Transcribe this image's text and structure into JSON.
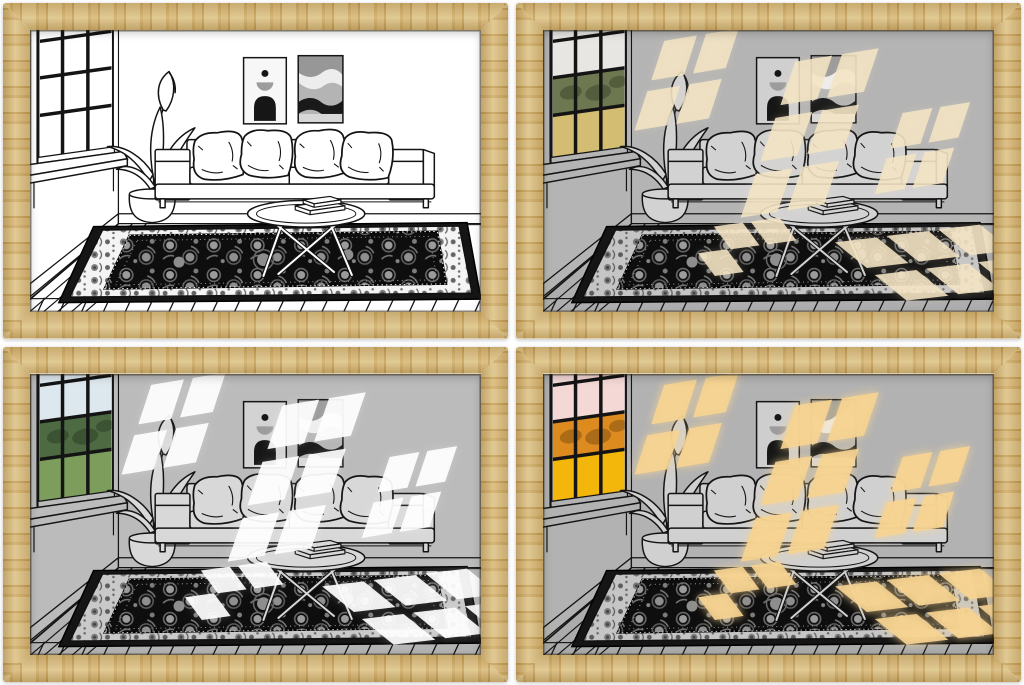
{
  "collage": {
    "rows": 2,
    "cols": 2,
    "panel_count": 4,
    "background": "#ffffff"
  },
  "frame": {
    "material_look": "light oak wood, mitered corners",
    "colors": {
      "a": "#d9bd80",
      "b": "#c9a55f",
      "c": "#d4b271",
      "d": "#bf9950"
    }
  },
  "scene_objects": [
    "paned window with landscape view",
    "potted houseplant",
    "three-seat sofa",
    "four throw pillows",
    "round coffee table",
    "stacked books",
    "two abstract wall art prints",
    "oriental area rug",
    "plank wood floor",
    "baseboard"
  ],
  "panels": [
    {
      "id": "top-left",
      "description": "Line-art living room, light off: pure black outlines on white",
      "light_opacity": "0",
      "glow_opacity": "0",
      "window_detail_opacity": "0",
      "colors": {
        "wall": "#ffffff",
        "floor": "#ffffff",
        "furniture": "#ffffff",
        "light": "#ffffff",
        "sky": "#ffffff",
        "trees": "#ffffff",
        "grass": "#ffffff",
        "rug_border": "#f4f4f4",
        "art_background": "#f7f7f7"
      }
    },
    {
      "id": "top-right",
      "description": "Gray living room with warm cream sunlight patches cast through the window; green landscape outside",
      "light_opacity": "0.88",
      "glow_opacity": "0.25",
      "window_detail_opacity": "0.22",
      "colors": {
        "wall": "#b4b4b4",
        "floor": "#aeaeae",
        "furniture": "#d2d2d2",
        "light": "#f4e4c4",
        "sky": "#e7e6e2",
        "trees": "#6d7750",
        "grass": "#d3bd72",
        "rug_border": "#c5c5c5",
        "art_background": "#d0d0d0"
      }
    },
    {
      "id": "bottom-left",
      "description": "Gray living room with bright white daylight patches cast through the window; blue sky and green lawn outside",
      "light_opacity": "0.92",
      "glow_opacity": "0.2",
      "window_detail_opacity": "0.22",
      "colors": {
        "wall": "#bbbbbb",
        "floor": "#b3b3b3",
        "furniture": "#d8d8d8",
        "light": "#ffffff",
        "sky": "#dde8ee",
        "trees": "#4d6a42",
        "grass": "#7d9d5c",
        "rug_border": "#c9c9c9",
        "art_background": "#d3d3d3"
      }
    },
    {
      "id": "bottom-right",
      "description": "Gray living room with glowing golden sunset light patches; pink sky and orange foliage outside, gold spill on rug",
      "light_opacity": "0.9",
      "glow_opacity": "0.85",
      "window_detail_opacity": "0.22",
      "colors": {
        "wall": "#b2b2b2",
        "floor": "#ababab",
        "furniture": "#d0d0d0",
        "light": "#f7d492",
        "sky": "#f4d8d6",
        "trees": "#dd8a1e",
        "grass": "#f2b70a",
        "rug_border": "#c5c5c5",
        "art_background": "#cecece"
      }
    }
  ]
}
